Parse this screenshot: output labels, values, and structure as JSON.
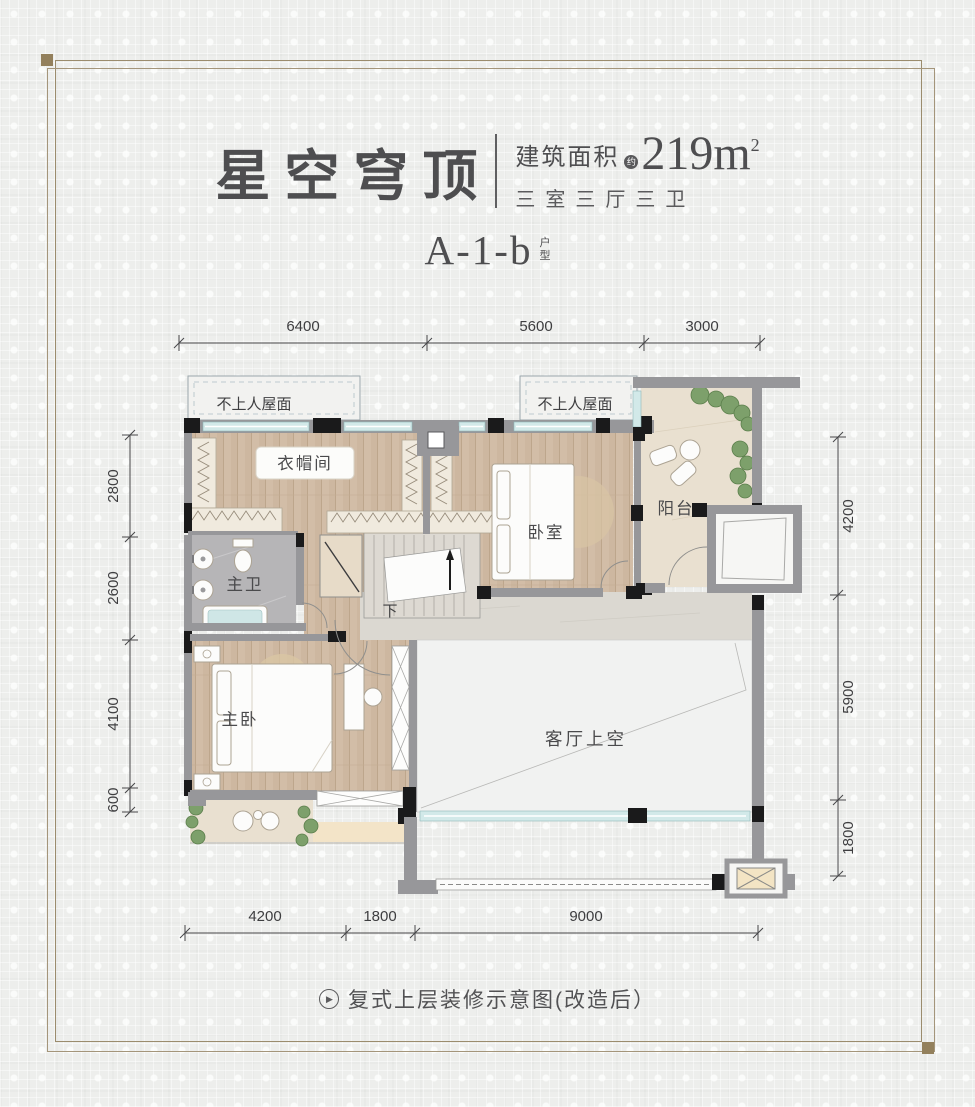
{
  "header": {
    "title": "星空穹顶",
    "area_label": "建筑面积",
    "area_approx": "约",
    "area_value": "219m",
    "area_sup": "2",
    "layout_summary": "三室三厅三卫",
    "unit_code": "A-1-b",
    "unit_suffix_top": "户",
    "unit_suffix_bottom": "型"
  },
  "plan": {
    "rooms": {
      "roof_left": "不上人屋面",
      "roof_right": "不上人屋面",
      "cloakroom": "衣帽间",
      "master_bath": "主卫",
      "bedroom": "卧室",
      "balcony": "阳台",
      "master_bedroom": "主卧",
      "living_void": "客厅上空",
      "stairs_down": "下"
    },
    "dimensions": {
      "top": [
        "6400",
        "5600",
        "3000"
      ],
      "left": [
        "2800",
        "2600",
        "4100",
        "600"
      ],
      "right": [
        "4200",
        "5900",
        "1800"
      ],
      "bottom": [
        "4200",
        "1800",
        "9000"
      ]
    }
  },
  "footer": {
    "play_glyph": "▶",
    "caption": "复式上层装修示意图(改造后）"
  },
  "colors": {
    "frame_line": "#9b8c6d",
    "corner_square": "#93805c",
    "wall_gray": "#97979a",
    "column_black": "#1a1a1b",
    "window_cyan": "#d2e9e9",
    "wood_floor": "#cdb7a0",
    "bath_marble": "#b6b5b7",
    "stone_floor": "#e9e0d0",
    "landing_marble": "#dbd8d1",
    "void_fill": "#f1f2f1",
    "plant_green": "#7da06b",
    "text_dark": "#4b4b4d"
  }
}
